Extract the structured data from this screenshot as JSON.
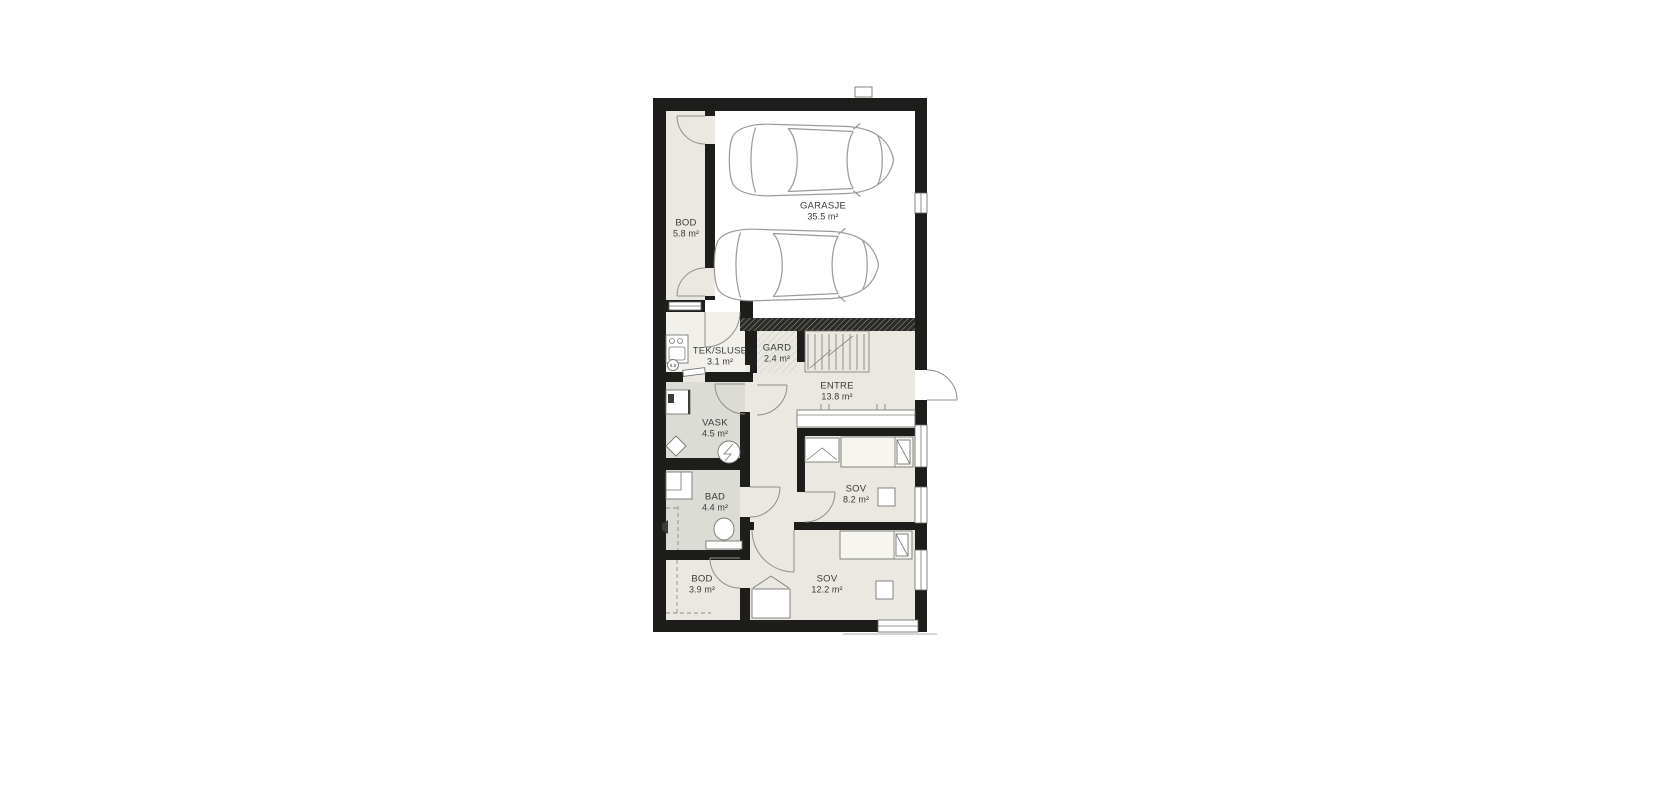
{
  "plan": {
    "rooms": {
      "garage": {
        "name": "GARASJE",
        "area": "35.5 m²"
      },
      "bod_top": {
        "name": "BOD",
        "area": "5.8 m²"
      },
      "sluse": {
        "name": "TEK/SLUSE",
        "area": "3.1 m²"
      },
      "gard": {
        "name": "GARD",
        "area": "2.4 m²"
      },
      "entre": {
        "name": "ENTRE",
        "area": "13.8 m²"
      },
      "vask": {
        "name": "VASK",
        "area": "4.5 m²"
      },
      "bad": {
        "name": "BAD",
        "area": "4.4 m²"
      },
      "sov_small": {
        "name": "SOV",
        "area": "8.2 m²"
      },
      "bod_bottom": {
        "name": "BOD",
        "area": "3.9 m²"
      },
      "sov_large": {
        "name": "SOV",
        "area": "12.2 m²"
      }
    },
    "marker": {
      "label": "8.8"
    },
    "colors": {
      "wall": "#1d1d1b",
      "room_fill": "#eae8e0",
      "wet_room_fill": "#dcdcd6",
      "sluse_fill": "#f1f0eb",
      "garage_fill": "#ffffff",
      "line": "#8f8f8b",
      "text": "#3a3a38"
    }
  }
}
